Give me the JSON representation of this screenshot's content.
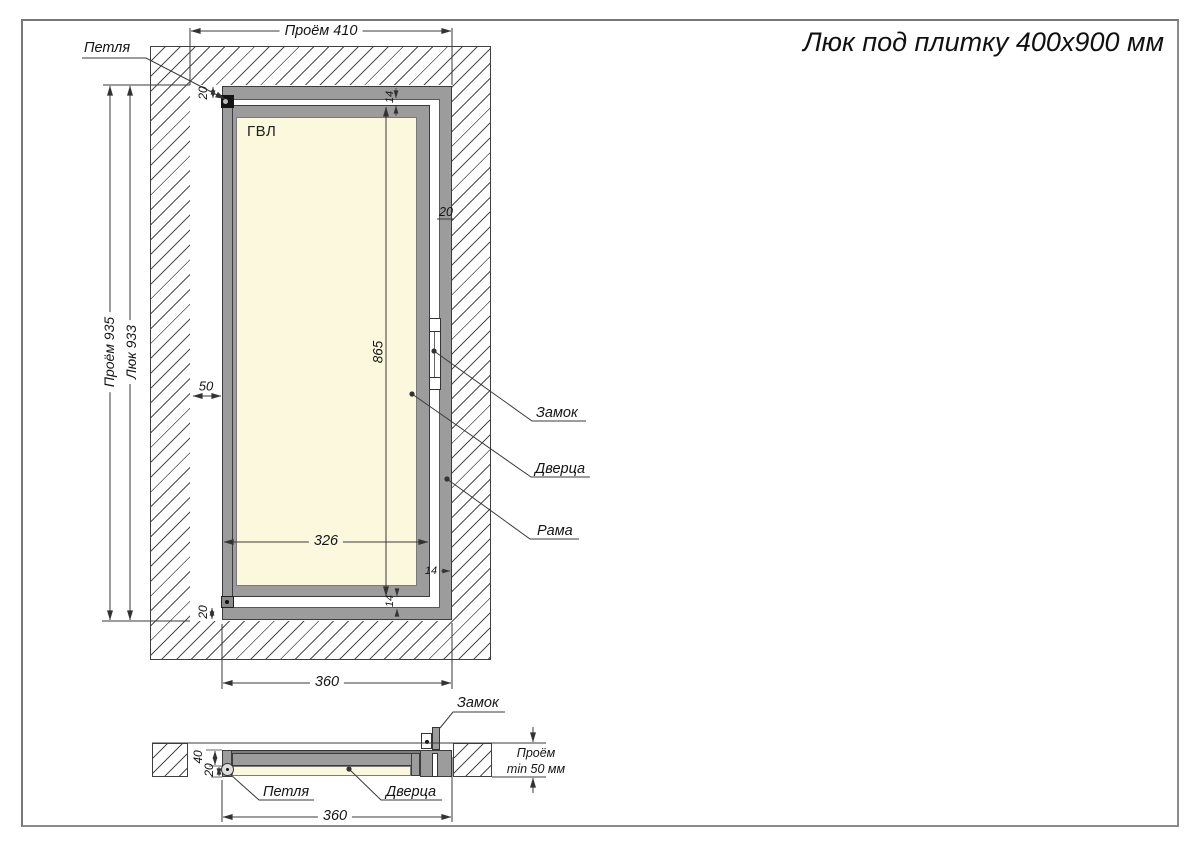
{
  "title": "Люк под плитку 400x900 мм",
  "front_view": {
    "panel_material": "ГВЛ",
    "labels": {
      "hinge": "Петля",
      "lock": "Замок",
      "door": "Дверца",
      "frame": "Рама"
    },
    "dims": {
      "opening_width": "Проём 410",
      "opening_height": "Проём 935",
      "hatch_height": "Люк 933",
      "side_gap": "50",
      "hinge_offset_top": "20",
      "frame_face_right": "20",
      "gap_top": "14",
      "gap_right": "14",
      "gap_bottom": "14",
      "hinge_offset_bottom": "20",
      "door_height": "865",
      "door_width": "326",
      "frame_width": "360"
    }
  },
  "section_view": {
    "labels": {
      "lock": "Замок",
      "hinge": "Петля",
      "door": "Дверца"
    },
    "dims": {
      "depth_total": "40",
      "depth_door": "20",
      "frame_width": "360",
      "opening_depth_line1": "Проём",
      "opening_depth_line2": "min 50 мм"
    }
  },
  "colors": {
    "frame_gray": "#9c9c9c",
    "panel_cream": "#fbf8dd",
    "line": "#3a3a3a",
    "hinge_black": "#141414"
  }
}
